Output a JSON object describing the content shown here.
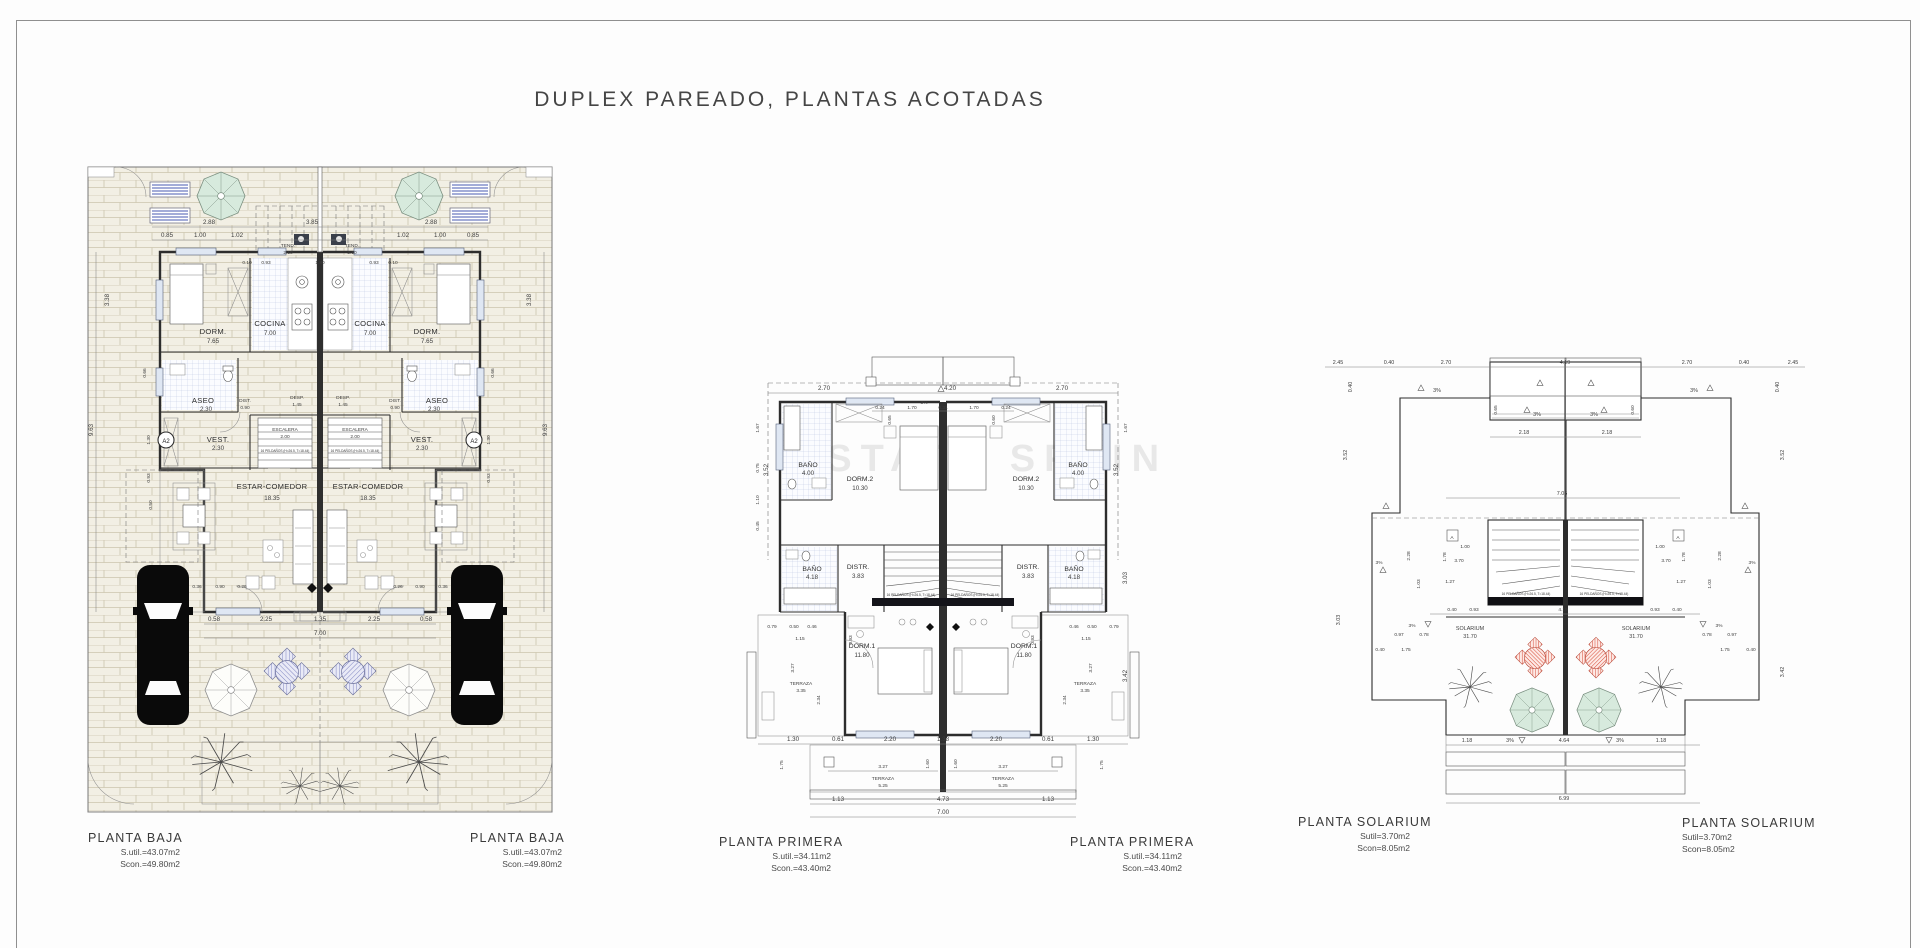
{
  "page": {
    "title": "DUPLEX PAREADO, PLANTAS ACOTADAS",
    "watermark": "ESTATE SPAIN"
  },
  "baja": {
    "title": "PLANTA BAJA",
    "sutil": "S.util.=43.07m2",
    "scon": "Scon.=49.80m2",
    "rooms": {
      "dorm": "DORM.",
      "dorm_a": "7.65",
      "cocina": "COCINA",
      "cocina_a": "7.00",
      "tend": "TEND.",
      "tend_a": "2.10",
      "aseo": "ASEO",
      "aseo_a": "2.30",
      "dist": "DIST.",
      "dist_a": "0.90",
      "desp": "DESP.",
      "desp_a": "1.45",
      "escalera": "ESCALERA",
      "escalera_a": "2.00",
      "vest": "VEST.",
      "vest_a": "2.30",
      "estar": "ESTAR-COMEDOR",
      "estar_a": "18.35",
      "a2": "A2",
      "stairs_note": "16 PELDAÑOS (H=26.5, T=18.44)"
    },
    "dims": {
      "d288": "2.88",
      "d385": "3.85",
      "d085": "0.85",
      "d100": "1.00",
      "d102": "1.02",
      "d010": "0.10",
      "d093": "0.93",
      "d180": "1.80",
      "d963": "9.63",
      "d338": "3.38",
      "d066": "0.66",
      "d130": "1.30",
      "d050": "0.50",
      "d036": "0.36",
      "d090": "0.90",
      "d026": "0.26",
      "d058": "0.58",
      "d225": "2.25",
      "d135": "1.35",
      "d700": "7.00"
    }
  },
  "primera": {
    "title": "PLANTA PRIMERA",
    "sutil": "S.util.=34.11m2",
    "scon": "Scon.=43.40m2",
    "rooms": {
      "banyo1": "BAÑO",
      "banyo1_a": "4.00",
      "dorm2": "DORM.2",
      "dorm2_a": "10.30",
      "banyo2": "BAÑO",
      "banyo2_a": "4.18",
      "distr": "DISTR.",
      "distr_a": "3.83",
      "dorm1": "DORM.1",
      "dorm1_a": "11.80",
      "terraza1": "TERRAZA",
      "terraza1_a": "3.35",
      "terraza2": "TERRAZA",
      "terraza2_a": "5.25",
      "stairs_note": "16 PELDAÑOS (H=26.5, T=18.44)"
    },
    "dims": {
      "d270": "2.70",
      "d420": "4.20",
      "slope": "3%",
      "d024": "0.24",
      "d170": "1.70",
      "d031": "0.31",
      "d065": "0.65",
      "d060": "0.60",
      "d352": "3.52",
      "d167": "1.67",
      "d075": "0.75",
      "d110": "1.10",
      "d045": "0.45",
      "d303": "3.03",
      "d342": "3.42",
      "d079": "0.79",
      "d050": "0.50",
      "d046": "0.46",
      "d115": "1.15",
      "d093": "0.93",
      "d175": "1.75",
      "d327": "3.27",
      "d234": "2.34",
      "d130": "1.30",
      "d061": "0.61",
      "d220": "2.20",
      "d138": "1.38",
      "d160": "1.60",
      "d113": "1.13",
      "d473": "4.73",
      "d700": "7.00"
    }
  },
  "solarium": {
    "title": "PLANTA SOLARIUM",
    "sutil": "Sutil=3.70m2",
    "scon": "Scon=8.05m2",
    "rooms": {
      "solarium": "SOLARIUM",
      "solarium_a": "31.70",
      "a_marker": "A",
      "stairs_note": "16 PELDAÑOS (H=26.5, T=18.44)"
    },
    "dims": {
      "d245": "2.45",
      "d040": "0.40",
      "d270": "2.70",
      "d419": "4.19",
      "slope": "3%",
      "d065": "0.65",
      "d060": "0.60",
      "d218": "2.18",
      "d352": "3.52",
      "d303": "3.03",
      "d342": "3.42",
      "d705": "7.05",
      "d100": "1.00",
      "d370": "3.70",
      "d228": "2.28",
      "d178": "1.78",
      "d103": "1.03",
      "d127": "1.27",
      "d093": "0.93",
      "d097": "0.97",
      "d078": "0.78",
      "d175": "1.75",
      "d118": "1.18",
      "d464": "4.64",
      "d699": "6.99"
    }
  }
}
